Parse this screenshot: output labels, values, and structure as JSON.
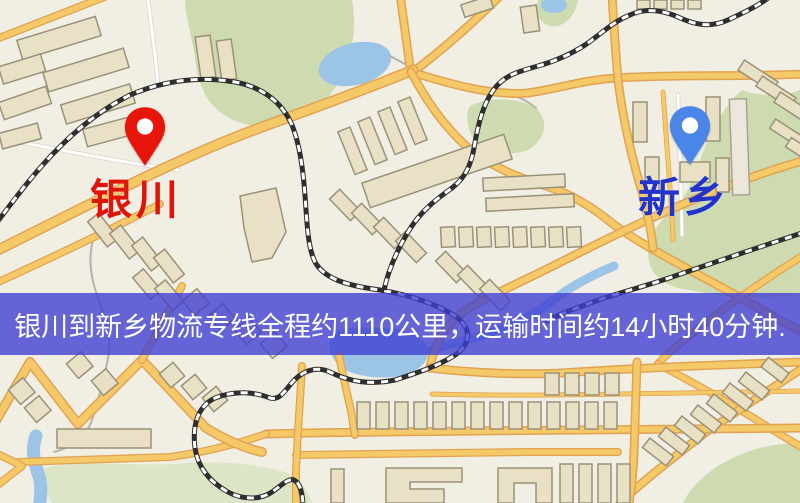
{
  "map": {
    "markers": [
      {
        "id": "origin",
        "label": "银川",
        "pin_color": "#e8150b",
        "label_color": "#e01408"
      },
      {
        "id": "destination",
        "label": "新乡",
        "pin_color": "#4a86e8",
        "label_color": "#2233cc"
      }
    ],
    "banner": {
      "text": "银川到新乡物流专线全程约1110公里，运输时间约14小时40分钟.",
      "background_color": "#3e3ed2",
      "background_opacity": 0.78,
      "text_color": "#ffffff"
    },
    "palette": {
      "background": "#f1eee4",
      "road_major": "#f5c868",
      "road_casing": "#e0a352",
      "park": "#cedbb0",
      "park_light": "#dce6c6",
      "water": "#9cc4e6",
      "building_fill": "#e9e1c6",
      "building_outline": "#9a9178",
      "railway": "#2e2e2e"
    }
  }
}
